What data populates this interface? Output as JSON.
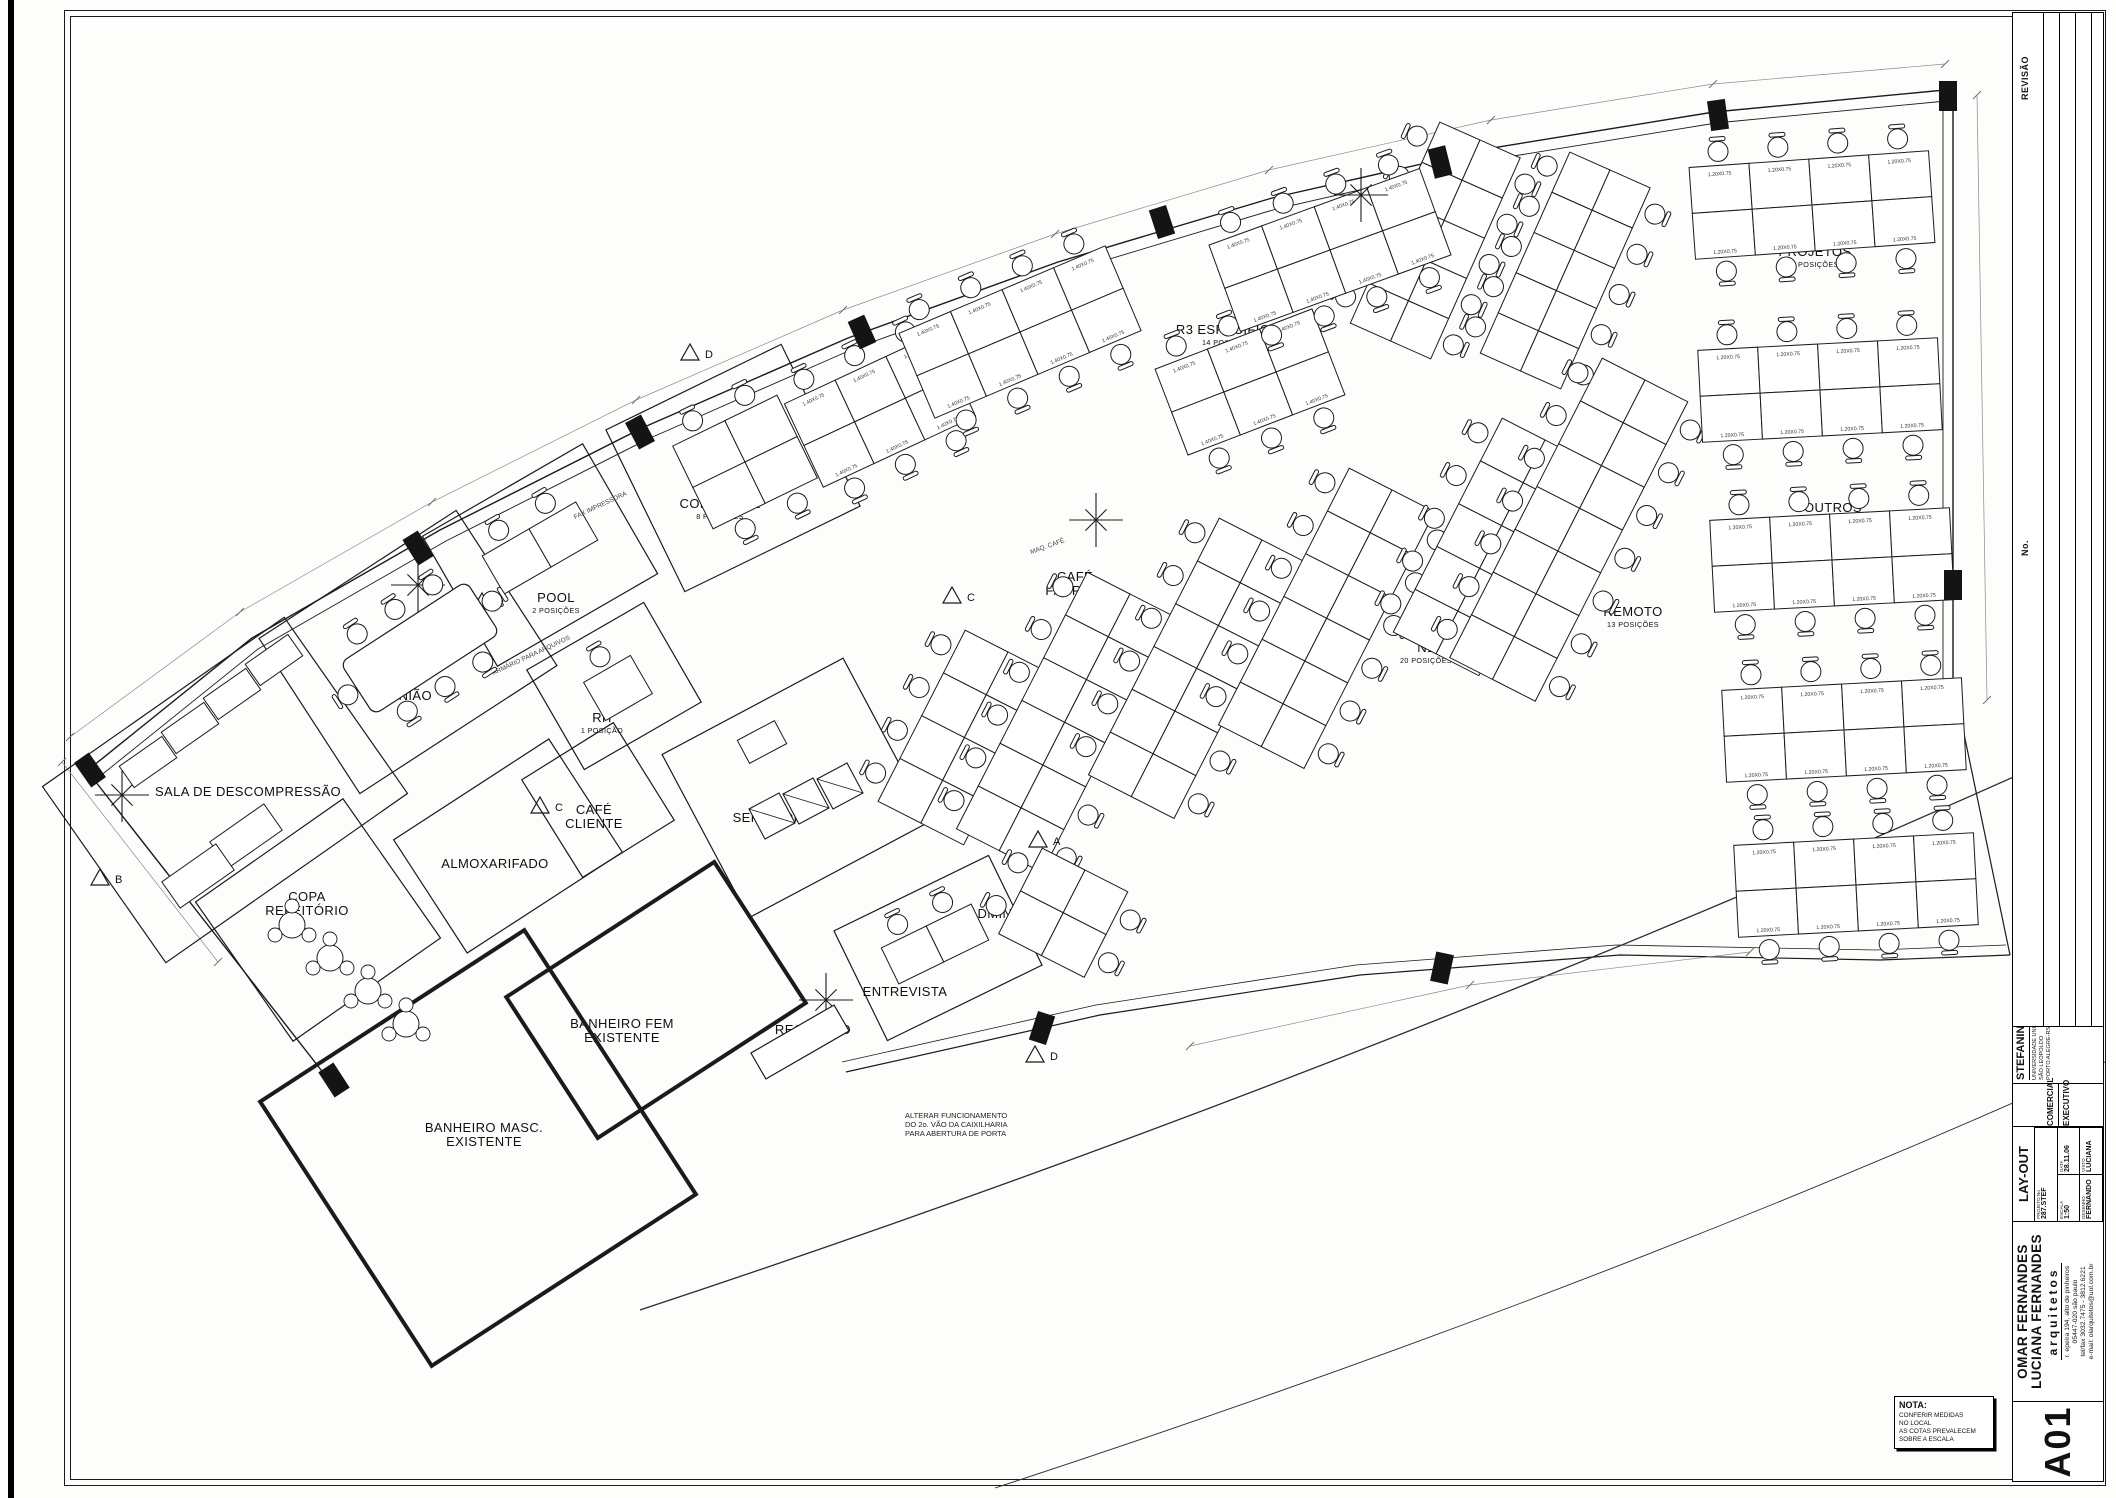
{
  "sheet": {
    "code": "A01",
    "nota_title": "NOTA:",
    "nota_lines": [
      "CONFERIR MEDIDAS",
      "NO LOCAL",
      "AS COTAS PREVALECEM",
      "SOBRE A ESCALA"
    ]
  },
  "title_block": {
    "revision_labels": {
      "no": "No.",
      "revisao": "REVISÃO",
      "data": "DATA"
    },
    "client_block": {
      "category": "COMERCIAL",
      "phase": "EXECUTIVO",
      "client": "STEFANINI",
      "location": [
        "UNIVERSIDADE UNISINOS",
        "SÃO LEOPOLDO",
        "PORTO ALEGRE-RS"
      ]
    },
    "sheet_block": {
      "title": "LAY-OUT",
      "projeto_label": "PROJETO No",
      "projeto": "287.STEF",
      "escala_label": "ESCALA",
      "escala": "1:50",
      "data_label": "DATA",
      "data": "28.11.06",
      "desenho_label": "DESENHO",
      "desenho": "FERNANDO",
      "visto_label": "VISTO",
      "visto": "LUCIANA"
    },
    "firm_block": {
      "names": [
        "OMAR FERNANDES",
        "LUCIANA FERNANDES"
      ],
      "suffix": "arquitetos",
      "address": [
        "r. epeira 194, alto de pinheiros",
        "05447-020 são paulo",
        "tel/fax 3032.7475 - 3812.6221",
        "e-mail: olarquitetos@uol.com.br"
      ]
    }
  },
  "plan": {
    "walls": [
      {
        "pts": [
          [
            88,
            770
          ],
          [
            252,
            638
          ],
          [
            440,
            530
          ],
          [
            642,
            428
          ],
          [
            848,
            338
          ],
          [
            1058,
            262
          ],
          [
            1272,
            198
          ],
          [
            1492,
            148
          ],
          [
            1714,
            112
          ],
          [
            1945,
            90
          ]
        ],
        "w": 1.4
      },
      {
        "pts": [
          [
            94,
            781
          ],
          [
            258,
            649
          ],
          [
            446,
            541
          ],
          [
            648,
            439
          ],
          [
            853,
            349
          ],
          [
            1063,
            273
          ],
          [
            1276,
            209
          ],
          [
            1495,
            159
          ],
          [
            1716,
            123
          ],
          [
            1946,
            101
          ]
        ],
        "w": 0.9
      },
      {
        "pts": [
          [
            1943,
            101
          ],
          [
            1943,
            700
          ]
        ],
        "w": 0.9
      },
      {
        "pts": [
          [
            1953,
            90
          ],
          [
            1953,
            705
          ]
        ],
        "w": 1.4
      },
      {
        "pts": [
          [
            88,
            772
          ],
          [
            243,
            970
          ],
          [
            332,
            1084
          ]
        ],
        "w": 1.4
      },
      {
        "pts": [
          [
            846,
            1072
          ],
          [
            1100,
            1015
          ],
          [
            1360,
            975
          ],
          [
            1620,
            955
          ],
          [
            1880,
            960
          ],
          [
            2010,
            955
          ]
        ],
        "w": 1.2
      },
      {
        "pts": [
          [
            842,
            1062
          ],
          [
            1096,
            1005
          ],
          [
            1356,
            965
          ],
          [
            1616,
            945
          ],
          [
            1876,
            950
          ],
          [
            2006,
            945
          ]
        ],
        "w": 0.8
      },
      {
        "pts": [
          [
            2010,
            955
          ],
          [
            1958,
            705
          ]
        ],
        "w": 1.2
      }
    ],
    "arcs": [
      {
        "d": "M640,1310 Q1350,1075 2056,758",
        "w": 1.3
      },
      {
        "d": "M995,1488 Q1600,1290 2105,1062",
        "w": 0.9
      }
    ],
    "dims": [
      {
        "pts": [
          [
            70,
            737
          ],
          [
            240,
            612
          ],
          [
            432,
            502
          ],
          [
            636,
            400
          ],
          [
            843,
            310
          ],
          [
            1055,
            234
          ],
          [
            1269,
            170
          ],
          [
            1491,
            120
          ],
          [
            1713,
            84
          ],
          [
            1945,
            64
          ]
        ]
      },
      {
        "pts": [
          [
            1977,
            95
          ],
          [
            1987,
            700
          ]
        ]
      },
      {
        "pts": [
          [
            62,
            762
          ],
          [
            218,
            962
          ]
        ]
      },
      {
        "pts": [
          [
            1190,
            1046
          ],
          [
            1470,
            985
          ],
          [
            1750,
            952
          ]
        ]
      }
    ],
    "rooms": [
      {
        "n": "sala-descompressao",
        "label": [
          "SALA DE DESCOMPRESSÃO"
        ],
        "cx": 225,
        "cy": 790,
        "w": 295,
        "h": 215,
        "a": -35,
        "lx": 248,
        "ly": 796
      },
      {
        "n": "copa-refeitorio",
        "label": [
          "COPA",
          "REFEITÓRIO"
        ],
        "cx": 318,
        "cy": 920,
        "w": 180,
        "h": 170,
        "a": -35,
        "lx": 307,
        "ly": 901
      },
      {
        "n": "reuniao",
        "label": [
          "REUNIÃO"
        ],
        "cx": 408,
        "cy": 652,
        "w": 235,
        "h": 185,
        "a": -33,
        "lx": 401,
        "ly": 700
      },
      {
        "n": "pool",
        "label": [
          "POOL"
        ],
        "sub": "2 POSIÇÕES",
        "cx": 540,
        "cy": 555,
        "w": 185,
        "h": 150,
        "a": -30,
        "lx": 556,
        "ly": 602
      },
      {
        "n": "rh",
        "label": [
          "RH"
        ],
        "sub": "1 POSIÇÃO",
        "cx": 614,
        "cy": 686,
        "w": 135,
        "h": 115,
        "a": -30,
        "lx": 602,
        "ly": 722
      },
      {
        "n": "comercial",
        "label": [
          "COMERCIAL"
        ],
        "sub": "8 POSIÇÕES",
        "cx": 733,
        "cy": 468,
        "w": 195,
        "h": 180,
        "a": -26,
        "lx": 720,
        "ly": 508
      },
      {
        "n": "cafe-cliente",
        "label": [
          "CAFÉ",
          "CLIENTE"
        ],
        "cx": 598,
        "cy": 800,
        "w": 108,
        "h": 115,
        "a": -32,
        "lx": 594,
        "ly": 814
      },
      {
        "n": "almoxarifado",
        "label": [
          "ALMOXARIFADO"
        ],
        "cx": 508,
        "cy": 846,
        "w": 185,
        "h": 135,
        "a": -33,
        "lx": 495,
        "ly": 868
      },
      {
        "n": "servidor",
        "label": [
          "SERVIDOR"
        ],
        "cx": 796,
        "cy": 788,
        "w": 205,
        "h": 185,
        "a": -28,
        "lx": 768,
        "ly": 822
      },
      {
        "n": "entrevista",
        "label": [
          "ENTREVISTA"
        ],
        "cx": 938,
        "cy": 948,
        "w": 172,
        "h": 122,
        "a": -26,
        "lx": 905,
        "ly": 996
      },
      {
        "n": "banheiro-fem",
        "label": [
          "BANHEIRO FEM",
          "EXISTENTE"
        ],
        "cx": 656,
        "cy": 1000,
        "w": 248,
        "h": 168,
        "a": -33,
        "t": 1,
        "lx": 622,
        "ly": 1028
      },
      {
        "n": "banheiro-masc",
        "label": [
          "BANHEIRO MASC.",
          "EXISTENTE"
        ],
        "cx": 478,
        "cy": 1148,
        "w": 315,
        "h": 315,
        "a": -33,
        "t": 1,
        "lx": 484,
        "ly": 1132
      }
    ],
    "labels": [
      {
        "n": "recepcao",
        "label": [
          "RECEPÇÃO"
        ],
        "x": 813,
        "y": 1034
      },
      {
        "n": "qualidade",
        "label": [
          "QUALIDADE"
        ],
        "sub": "6 POSIÇÕES",
        "x": 968,
        "y": 783
      },
      {
        "n": "administrativo",
        "label": [
          "ADMINISTRATIVO"
        ],
        "sub": "4 POSIÇÕES",
        "x": 1026,
        "y": 918
      },
      {
        "n": "se1",
        "label": [
          "SE1"
        ],
        "sub": "11 POSIÇÕES",
        "x": 1097,
        "y": 752
      },
      {
        "n": "cafe-fabrica",
        "label": [
          "CAFÉ",
          "FÁBRICA"
        ],
        "x": 1075,
        "y": 581
      },
      {
        "n": "remoto-atc",
        "label": [
          "REMOTO ATC"
        ],
        "sub": "11 POSIÇÕES",
        "x": 1218,
        "y": 694
      },
      {
        "n": "n1",
        "label": [
          "N1"
        ],
        "sub": "20 POSIÇÕES",
        "x": 1426,
        "y": 652
      },
      {
        "n": "remoto",
        "label": [
          "REMOTO"
        ],
        "sub": "13 POSIÇÕES",
        "x": 1633,
        "y": 616
      },
      {
        "n": "r3",
        "label": [
          "R3"
        ],
        "sub": "14 POSIÇÕES",
        "x": 940,
        "y": 375
      },
      {
        "n": "r3-especifico",
        "label": [
          "R3 ESPECÍFICO"
        ],
        "sub": "14 POSIÇÕES",
        "x": 1228,
        "y": 334
      },
      {
        "n": "se2",
        "label": [
          "SE2"
        ],
        "sub": "20 POSIÇÕES",
        "x": 1535,
        "y": 281
      },
      {
        "n": "projetos",
        "label": [
          "PROJETOS"
        ],
        "sub": "6 POSIÇÕES",
        "x": 1815,
        "y": 256
      },
      {
        "n": "outros",
        "label": [
          "OUTROS"
        ],
        "sub": "32 POSIÇÕES",
        "x": 1833,
        "y": 512
      }
    ],
    "chains": [
      {
        "n": "se2-a",
        "x": 1480,
        "y": 140,
        "rows": 5,
        "a": 24,
        "cell": 44
      },
      {
        "n": "se2-b",
        "x": 1610,
        "y": 170,
        "rows": 5,
        "a": 24,
        "cell": 44
      },
      {
        "n": "qualidade",
        "x": 1008,
        "y": 652,
        "rows": 4,
        "a": 27,
        "cell": 48
      },
      {
        "n": "se1",
        "x": 1130,
        "y": 594,
        "rows": 6,
        "a": 27,
        "cell": 48
      },
      {
        "n": "remoto-atc",
        "x": 1262,
        "y": 540,
        "rows": 6,
        "a": 27,
        "cell": 48
      },
      {
        "n": "n1-a",
        "x": 1392,
        "y": 490,
        "rows": 6,
        "a": 27,
        "cell": 48
      },
      {
        "n": "n1-b",
        "x": 1545,
        "y": 440,
        "rows": 5,
        "a": 27,
        "cell": 48
      },
      {
        "n": "remoto",
        "x": 1645,
        "y": 380,
        "rows": 7,
        "a": 27,
        "cell": 48
      },
      {
        "n": "administrativo",
        "x": 1085,
        "y": 870,
        "rows": 2,
        "a": 27,
        "cell": 48
      }
    ],
    "grids": [
      {
        "n": "r3-a",
        "cx": 880,
        "cy": 410,
        "rows": 2,
        "cols": 3,
        "cw": 56,
        "ch": 46,
        "a": -25,
        "cl": "1.40X0.75"
      },
      {
        "n": "r3-b",
        "cx": 1020,
        "cy": 332,
        "rows": 2,
        "cols": 4,
        "cw": 56,
        "ch": 46,
        "a": -23,
        "cl": "1.40X0.75"
      },
      {
        "n": "r3e-a",
        "cx": 1250,
        "cy": 382,
        "rows": 2,
        "cols": 3,
        "cw": 56,
        "ch": 46,
        "a": -21,
        "cl": "1.40X0.75"
      },
      {
        "n": "r3e-b",
        "cx": 1330,
        "cy": 250,
        "rows": 2,
        "cols": 4,
        "cw": 56,
        "ch": 46,
        "a": -20,
        "cl": "1.40X0.75"
      },
      {
        "n": "projetos",
        "cx": 1812,
        "cy": 205,
        "rows": 2,
        "cols": 4,
        "cw": 60,
        "ch": 46,
        "a": -4,
        "cl": "1.20X0.75"
      },
      {
        "n": "outros-1",
        "cx": 1820,
        "cy": 390,
        "rows": 2,
        "cols": 4,
        "cw": 60,
        "ch": 46,
        "a": -3,
        "cl": "1.20X0.75"
      },
      {
        "n": "outros-2",
        "cx": 1832,
        "cy": 560,
        "rows": 2,
        "cols": 4,
        "cw": 60,
        "ch": 46,
        "a": -3,
        "cl": "1.20X0.75"
      },
      {
        "n": "outros-3",
        "cx": 1844,
        "cy": 730,
        "rows": 2,
        "cols": 4,
        "cw": 60,
        "ch": 46,
        "a": -3,
        "cl": "1.20X0.75"
      },
      {
        "n": "outros-4",
        "cx": 1856,
        "cy": 885,
        "rows": 2,
        "cols": 4,
        "cw": 60,
        "ch": 46,
        "a": -3,
        "cl": "1.20X0.75"
      },
      {
        "n": "comercial",
        "cx": 745,
        "cy": 462,
        "rows": 2,
        "cols": 2,
        "cw": 58,
        "ch": 46,
        "a": -26,
        "cl": ""
      },
      {
        "n": "pool",
        "cx": 540,
        "cy": 548,
        "rows": 1,
        "cols": 2,
        "cw": 54,
        "ch": 44,
        "a": -30,
        "cl": ""
      },
      {
        "n": "rh",
        "cx": 618,
        "cy": 688,
        "rows": 1,
        "cols": 1,
        "cw": 54,
        "ch": 44,
        "a": -30,
        "cl": ""
      },
      {
        "n": "entrevista",
        "cx": 935,
        "cy": 944,
        "rows": 1,
        "cols": 2,
        "cw": 50,
        "ch": 40,
        "a": -26,
        "cl": ""
      }
    ],
    "columns": [
      [
        418,
        548,
        -32
      ],
      [
        640,
        432,
        -28
      ],
      [
        862,
        332,
        -24
      ],
      [
        1162,
        222,
        -18
      ],
      [
        1440,
        162,
        -14
      ],
      [
        1718,
        115,
        -8
      ],
      [
        1948,
        96,
        0
      ],
      [
        1953,
        585,
        0
      ],
      [
        90,
        770,
        -35
      ],
      [
        1042,
        1028,
        18
      ],
      [
        1442,
        968,
        12
      ],
      [
        334,
        1080,
        -33
      ]
    ],
    "stars": [
      [
        418,
        585
      ],
      [
        1361,
        195
      ],
      [
        1096,
        520
      ],
      [
        826,
        1000
      ],
      [
        122,
        795
      ]
    ],
    "markers": [
      {
        "l": "A",
        "x": 1038,
        "y": 840
      },
      {
        "l": "B",
        "x": 482,
        "y": 602
      },
      {
        "l": "B",
        "x": 100,
        "y": 878
      },
      {
        "l": "C",
        "x": 952,
        "y": 596
      },
      {
        "l": "C",
        "x": 540,
        "y": 806
      },
      {
        "l": "D",
        "x": 690,
        "y": 353
      },
      {
        "l": "D",
        "x": 1035,
        "y": 1055
      }
    ],
    "note": {
      "x": 905,
      "y": 1118,
      "lines": [
        "ALTERAR FUNCIONAMENTO",
        "DO 2o. VÃO DA CAIXILHARIA",
        "PARA ABERTURA DE PORTA"
      ]
    },
    "tiny_labels": [
      {
        "t": "ARMÁRIO PARA ARQUIVOS",
        "x": 532,
        "y": 657,
        "a": -25
      },
      {
        "t": "FAX IMPRESSORA",
        "x": 601,
        "y": 507,
        "a": -25
      },
      {
        "t": "MAQ. CAFÉ",
        "x": 1048,
        "y": 548,
        "a": -20
      }
    ],
    "furniture": {
      "meeting_table": {
        "cx": 420,
        "cy": 648,
        "w": 150,
        "h": 62,
        "a": -33
      },
      "sofas": {
        "a": -35,
        "w": 52,
        "h": 26,
        "pos": [
          [
            148,
            762
          ],
          [
            190,
            728
          ],
          [
            232,
            694
          ],
          [
            274,
            660
          ]
        ]
      },
      "futons": {
        "a": -35,
        "w": 66,
        "h": 32,
        "pos": [
          [
            246,
            836
          ],
          [
            198,
            876
          ]
        ]
      },
      "copa_tables": [
        [
          292,
          925
        ],
        [
          330,
          958
        ],
        [
          368,
          991
        ],
        [
          406,
          1024
        ]
      ],
      "racks": {
        "a": -28,
        "s": 34,
        "pos": [
          [
            772,
            816
          ],
          [
            806,
            801
          ],
          [
            840,
            786
          ]
        ]
      },
      "bateria": {
        "cx": 762,
        "cy": 742,
        "w": 42,
        "h": 26,
        "a": -28
      },
      "counter": {
        "cx": 800,
        "cy": 1042,
        "w": 96,
        "h": 30,
        "a": -30
      }
    }
  }
}
